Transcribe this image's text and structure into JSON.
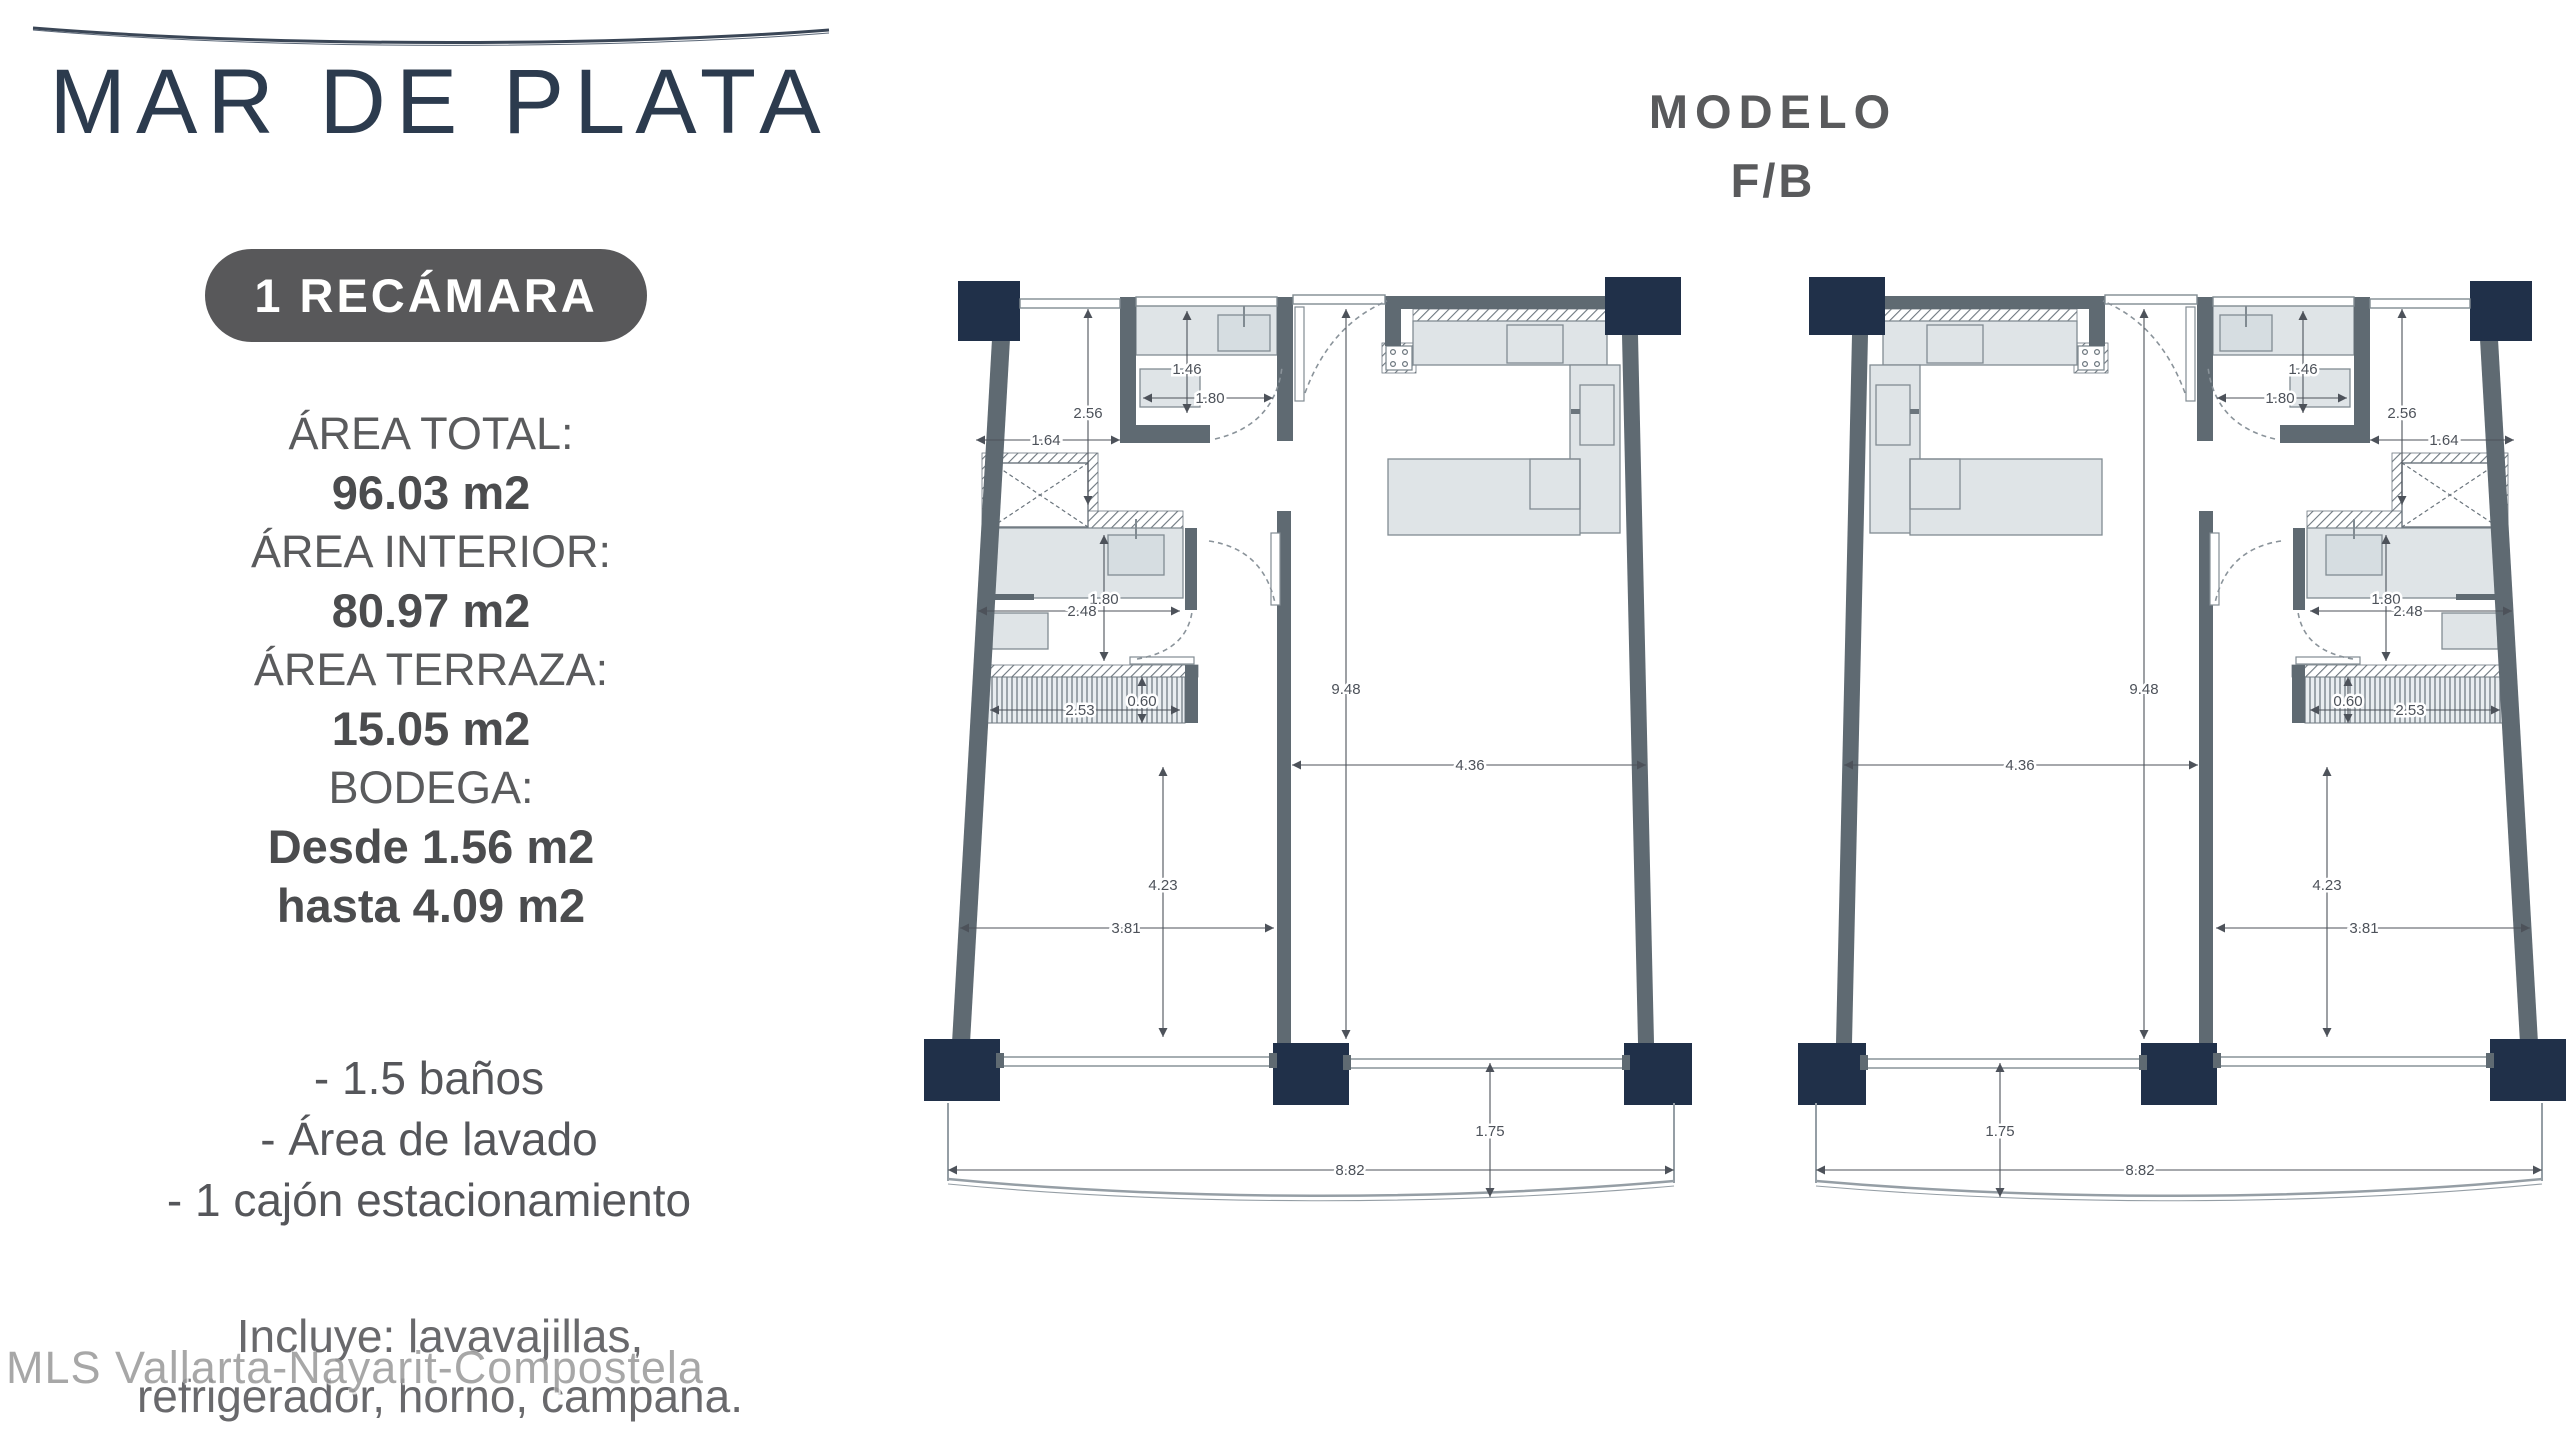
{
  "header": {
    "title": "MAR DE PLATA",
    "badge": "1 RECÁMARA"
  },
  "specs": [
    {
      "text": "ÁREA TOTAL:",
      "bold": false
    },
    {
      "text": "96.03 m2",
      "bold": true
    },
    {
      "text": "ÁREA INTERIOR:",
      "bold": false
    },
    {
      "text": "80.97 m2",
      "bold": true
    },
    {
      "text": "ÁREA TERRAZA:",
      "bold": false
    },
    {
      "text": "15.05 m2",
      "bold": true
    },
    {
      "text": "BODEGA:",
      "bold": false
    },
    {
      "text": "Desde 1.56 m2",
      "bold": true
    },
    {
      "text": "hasta 4.09 m2",
      "bold": true
    }
  ],
  "features": [
    "- 1.5 baños",
    "- Área de lavado",
    "- 1 cajón estacionamiento"
  ],
  "includes": [
    "Incluye: lavavajillas,",
    "refrigerador, horno, campana."
  ],
  "watermark": {
    "text": "MLS Vallarta-Nayarit-Compostela"
  },
  "model": {
    "line1": "MODELO",
    "line2": "F/B"
  },
  "floor_plans": {
    "units": [
      {
        "name": "unit-left",
        "mirrored": false
      },
      {
        "name": "unit-right",
        "mirrored": true
      }
    ],
    "colors": {
      "column": "#203049",
      "wall": "#5f6a72",
      "furniture": "#dfe4e7",
      "furniture_dark": "#d6dde1",
      "stroke": "#818b92",
      "dimension": "#4d525a"
    },
    "dimensions": [
      {
        "value": "1.46",
        "o": "v",
        "x": 257,
        "y1": 38,
        "y2": 140,
        "lx": 257,
        "ly": 96
      },
      {
        "value": "1.80",
        "o": "h",
        "y": 125,
        "x1": 213,
        "x2": 343,
        "lx": 280,
        "ly": 125
      },
      {
        "value": "2.56",
        "o": "v",
        "x": 158,
        "y1": 36,
        "y2": 232,
        "lx": 158,
        "ly": 140
      },
      {
        "value": "1.64",
        "o": "h",
        "y": 167,
        "x1": 46,
        "x2": 190,
        "lx": 116,
        "ly": 167
      },
      {
        "value": "1.80",
        "o": "v",
        "x": 174,
        "y1": 262,
        "y2": 388,
        "lx": 174,
        "ly": 326
      },
      {
        "value": "2.48",
        "o": "h",
        "y": 338,
        "x1": 48,
        "x2": 250,
        "lx": 152,
        "ly": 338
      },
      {
        "value": "0.60",
        "o": "v",
        "x": 212,
        "y1": 404,
        "y2": 450,
        "lx": 212,
        "ly": 428
      },
      {
        "value": "2.53",
        "o": "h",
        "y": 437,
        "x1": 60,
        "x2": 250,
        "lx": 150,
        "ly": 437
      },
      {
        "value": "9.48",
        "o": "v",
        "x": 416,
        "y1": 36,
        "y2": 766,
        "lx": 416,
        "ly": 416
      },
      {
        "value": "4.36",
        "o": "h",
        "y": 492,
        "x1": 362,
        "x2": 716,
        "lx": 540,
        "ly": 492
      },
      {
        "value": "4.23",
        "o": "v",
        "x": 233,
        "y1": 494,
        "y2": 764,
        "lx": 233,
        "ly": 612
      },
      {
        "value": "3.81",
        "o": "h",
        "y": 655,
        "x1": 30,
        "x2": 344,
        "lx": 196,
        "ly": 655
      },
      {
        "value": "1.75",
        "o": "v",
        "x": 560,
        "y1": 790,
        "y2": 924,
        "lx": 560,
        "ly": 858
      },
      {
        "value": "8.82",
        "o": "h",
        "y": 897,
        "x1": 18,
        "x2": 744,
        "lx": 420,
        "ly": 897
      }
    ]
  }
}
